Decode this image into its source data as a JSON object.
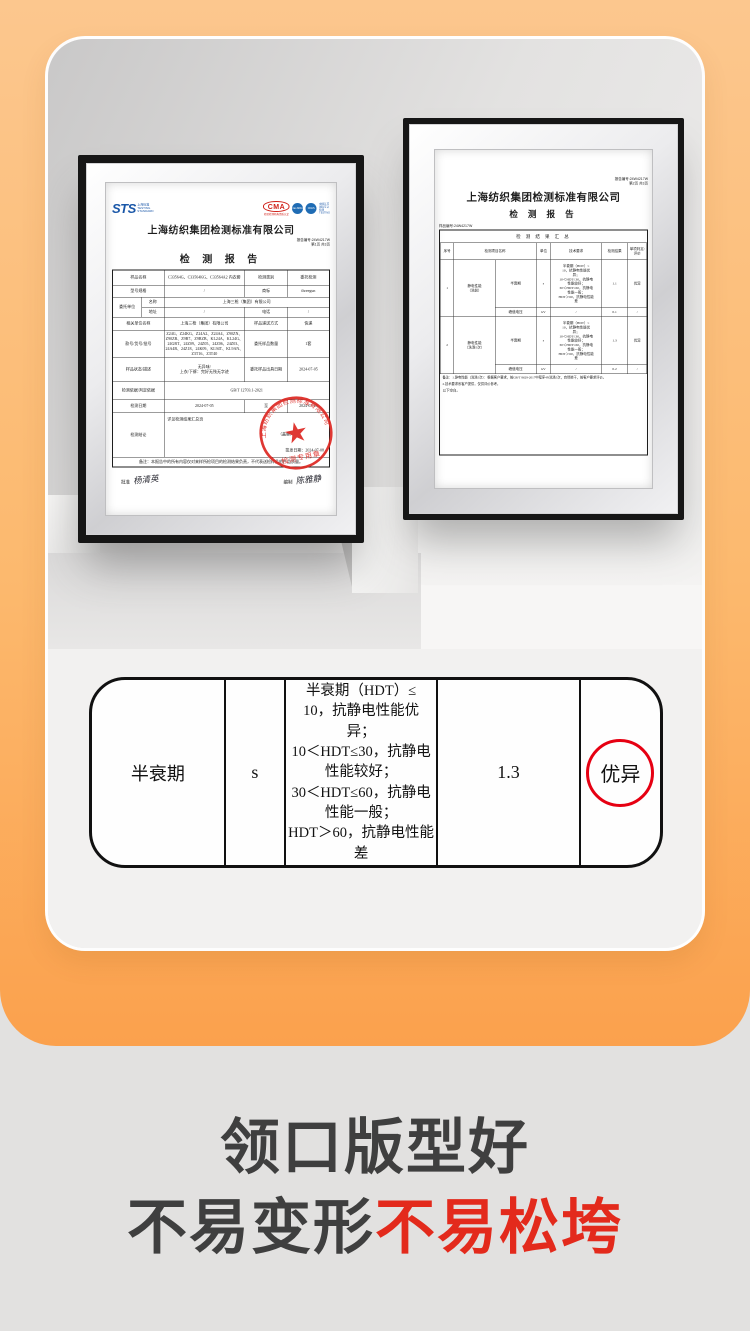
{
  "page": {
    "bg_color": "#e2e1e0",
    "orange_top": "#fcc78e",
    "orange_bottom": "#fba14d",
    "red_accent": "#e60012"
  },
  "left_cert": {
    "logos": {
      "sts": "STS",
      "sts_sub": "上海标准\nTESTING\nSTANDARD",
      "cma": "CMA",
      "cma_sub": "检验检测机构资质认定",
      "badge1": "ilac-MRA",
      "badge2": "CNAS",
      "side_note": "中国认可\n国际互认\n检测\nTESTING"
    },
    "title": "上海纺织集团检测标准有限公司",
    "report_no": "报告编号:24W4217W",
    "page_no": "第1页 共3页",
    "report_title": "检 测 报 告",
    "info": {
      "r1l": "样品名称",
      "r1v": "C33564G、C33564KG、C33564A2 内衣套",
      "r1l2": "检测类别",
      "r1v2": "委托检测",
      "r2l": "型号规格",
      "r2v": "/",
      "r2l2": "商标",
      "r2v2": "threegun",
      "r3l": "委托单位",
      "r3al": "名称",
      "r3av": "上海三枪（集团）有限公司",
      "r3bl": "地址",
      "r3bv": "/",
      "r3bl2": "电话",
      "r3bv2": "/",
      "r4l": "相关单位名称",
      "r4v": "上海三枪（集团）有限公司",
      "r4l2": "样品递送方式",
      "r4v2": "快递",
      "r5l": "款号/货号/批号",
      "r5v": "Z24G、Z24KG、Z24A2、Z24A4、Z90ZN、Z90ZB、Z9B7、Z9BZB、KL24A、KL24G、24GBT、24Z09、24Z05、24Z06、24Z03、24A4B、24Z18、24K09、KL94T、KL9AN、Z3T16、Z3T40",
      "r5l2": "委托样品数量",
      "r5v2": "1套",
      "r6l": "样品状态/描述",
      "r6v": "无异味/\n上衣/下裤：完好无残无字迹",
      "r6l2": "委托样品出具日期",
      "r6v2": "2024-07-05",
      "r7l": "检测依据/判定依据",
      "r7v": "GB/T 12703.1-2021",
      "r8l": "检测日期",
      "r8v": "2024-07-05",
      "r8m": "至",
      "r8v2": "2024-07-08",
      "r9l": "检测结论",
      "r9v": "详见检测结果汇总页",
      "r9seal": "（盖章）",
      "r9d": "签发日期：2024-07-08",
      "note": "备注：本报告中的所有内容仅对来样所检项目的检测结果负责，不代表送检样品的产品质量。",
      "sig1l": "批准",
      "sig1": "杨清英",
      "sig2l": "编制",
      "sig2": "陈雅静"
    },
    "stamp": {
      "ring_text": "上海纺织集团检测标准有限公司",
      "bottom_text": "检测专用章",
      "star": "★"
    }
  },
  "right_cert": {
    "report_no": "报告编号:24W4217W",
    "page_no": "第2页 共3页",
    "title": "上海纺织集团检测标准有限公司",
    "report_title": "检 测 报 告",
    "sample_no": "样品编号:24W4217W",
    "table_title": "检 测 结 果 汇 总",
    "headers": {
      "no": "序号",
      "item": "检测项目名称",
      "unit": "单位",
      "req": "技术要求",
      "result": "检测结果",
      "eval": "单项判定/\n评价"
    },
    "tech_req": "半衰期（HDT）≤\n10，抗静电性能优\n异；\n10＜HDT≤30，抗静电\n性能较好；\n30＜HDT≤60，抗静电\n性能一般；\nHDT＞60，抗静电性能\n差",
    "rows": {
      "r1": {
        "no": "1",
        "group": "静电性能\n（洗前）",
        "sub": "半衰期",
        "unit": "s",
        "result": "1.1",
        "eval": "优异"
      },
      "r1b": {
        "sub": "峰值电压",
        "unit": "kV",
        "req": "/",
        "result": "0.1",
        "eval": "/"
      },
      "r2": {
        "no": "2",
        "group": "静电性能\n（洗涤5次）",
        "sub": "半衰期",
        "unit": "s",
        "result": "1.3",
        "eval": "优异"
      },
      "r2b": {
        "sub": "峰值电压",
        "unit": "kV",
        "req": "/",
        "result": "0.2",
        "eval": "/"
      }
    },
    "note1": "备注：1.静电性能（洗涤5次）：根据客户要求，按GB/T 8629-2017中程序4N洗涤5次，自然晾干，按客户要求评价。",
    "note2": "2.技术要求系客户提供，仅供评价参考。",
    "blank": "以下空白。"
  },
  "summary_table": {
    "col1": "半衰期",
    "col2": "s",
    "col3": "半衰期（HDT）≤\n10，抗静电性能优\n异；\n10＜HDT≤30，抗静电\n性能较好；\n30＜HDT≤60，抗静电\n性能一般；\nHDT＞60，抗静电性能\n差",
    "col4": "1.3",
    "col5": "优异"
  },
  "caption": {
    "line1": "领口版型好",
    "line2_dark": "不易变形",
    "line2_red": "不易松垮"
  }
}
